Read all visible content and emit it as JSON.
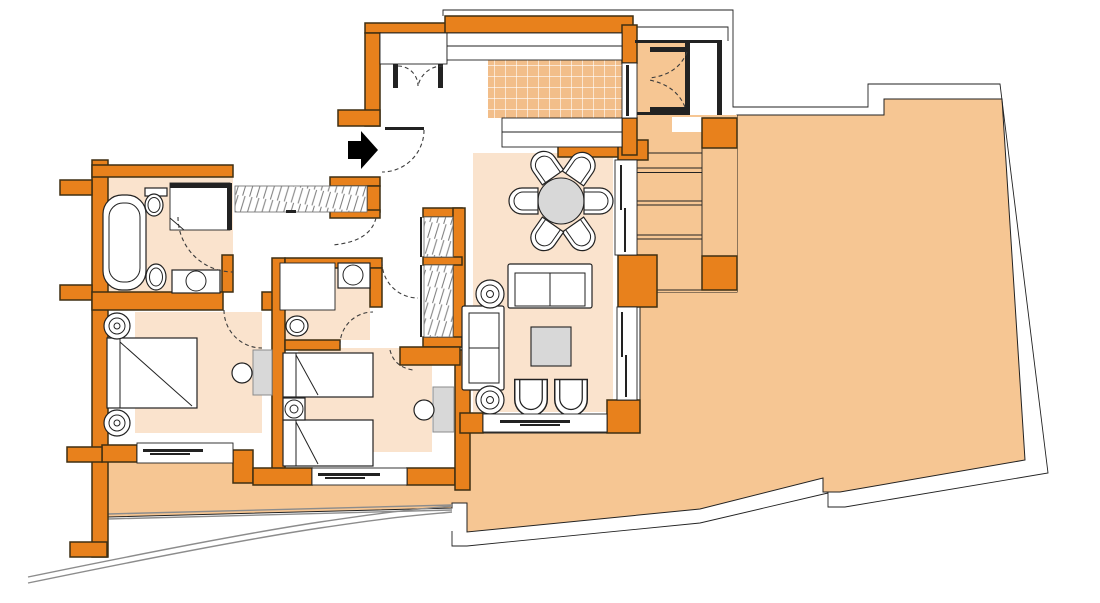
{
  "meta": {
    "type": "architectural-floor-plan",
    "description": "Two-bedroom apartment floor plan with kitchen, dining and living areas opening onto a large wrap-around terrace",
    "visible_text": "none"
  },
  "colors": {
    "background": "#ffffff",
    "wall": "#e8811c",
    "wall_outline": "#3f2f12",
    "terrace": "#f6c693",
    "room_floor": "#fae3cd",
    "tile": "#f2be8a",
    "tile_grout": "#ffffff",
    "furniture_fill": "#ffffff",
    "furniture_gray": "#d8d8d8",
    "line": "#222222",
    "door_arc": "#3c3c3c",
    "railing": "#8c8c8c",
    "arrow": "#000000"
  },
  "rooms": [
    {
      "id": "entry-hall",
      "label": "entry-hall",
      "items": [
        {
          "name": "entrance-arrow",
          "count": 1
        },
        {
          "name": "entrance-door",
          "count": 1
        },
        {
          "name": "closet-double-doors",
          "count": 1
        },
        {
          "name": "built-in-wardrobe",
          "count": 2
        }
      ]
    },
    {
      "id": "kitchen",
      "label": "kitchen",
      "items": [
        {
          "name": "counter",
          "count": 2
        },
        {
          "name": "tiled-floor",
          "count": 1
        },
        {
          "name": "service-door",
          "count": 1
        }
      ]
    },
    {
      "id": "dining-area",
      "label": "dining-area",
      "items": [
        {
          "name": "round-dining-table",
          "count": 1
        },
        {
          "name": "dining-chair",
          "count": 6
        }
      ]
    },
    {
      "id": "living-area",
      "label": "living-area",
      "items": [
        {
          "name": "sofa",
          "count": 2
        },
        {
          "name": "coffee-table",
          "count": 1
        },
        {
          "name": "armchair",
          "count": 2
        },
        {
          "name": "floor-plant",
          "count": 2
        },
        {
          "name": "window",
          "count": 1
        }
      ]
    },
    {
      "id": "master-bedroom",
      "label": "master-bedroom",
      "items": [
        {
          "name": "double-bed",
          "count": 1
        },
        {
          "name": "round-nightstand",
          "count": 2
        },
        {
          "name": "dresser",
          "count": 1
        },
        {
          "name": "stool",
          "count": 1
        },
        {
          "name": "window",
          "count": 1
        }
      ]
    },
    {
      "id": "master-bathroom",
      "label": "master-bathroom",
      "items": [
        {
          "name": "bathtub",
          "count": 1
        },
        {
          "name": "toilet",
          "count": 1
        },
        {
          "name": "bidet",
          "count": 1
        },
        {
          "name": "shower",
          "count": 1
        },
        {
          "name": "washbasin-vanity",
          "count": 1
        }
      ]
    },
    {
      "id": "bedroom-2",
      "label": "bedroom-2",
      "items": [
        {
          "name": "single-bed",
          "count": 2
        },
        {
          "name": "nightstand",
          "count": 1
        },
        {
          "name": "dresser",
          "count": 1
        },
        {
          "name": "stool",
          "count": 1
        },
        {
          "name": "window",
          "count": 1
        }
      ]
    },
    {
      "id": "bathroom-2",
      "label": "bathroom-2",
      "items": [
        {
          "name": "shower",
          "count": 1
        },
        {
          "name": "washbasin",
          "count": 1
        },
        {
          "name": "toilet",
          "count": 1
        }
      ]
    },
    {
      "id": "terrace-storage-room",
      "label": "terrace-storage-room",
      "items": [
        {
          "name": "double-doors",
          "count": 1
        }
      ]
    },
    {
      "id": "terrace",
      "label": "terrace",
      "items": [
        {
          "name": "steps",
          "count": 3
        },
        {
          "name": "column",
          "count": 2
        },
        {
          "name": "parapet",
          "count": 1
        },
        {
          "name": "curved-railing",
          "count": 1
        }
      ]
    }
  ]
}
